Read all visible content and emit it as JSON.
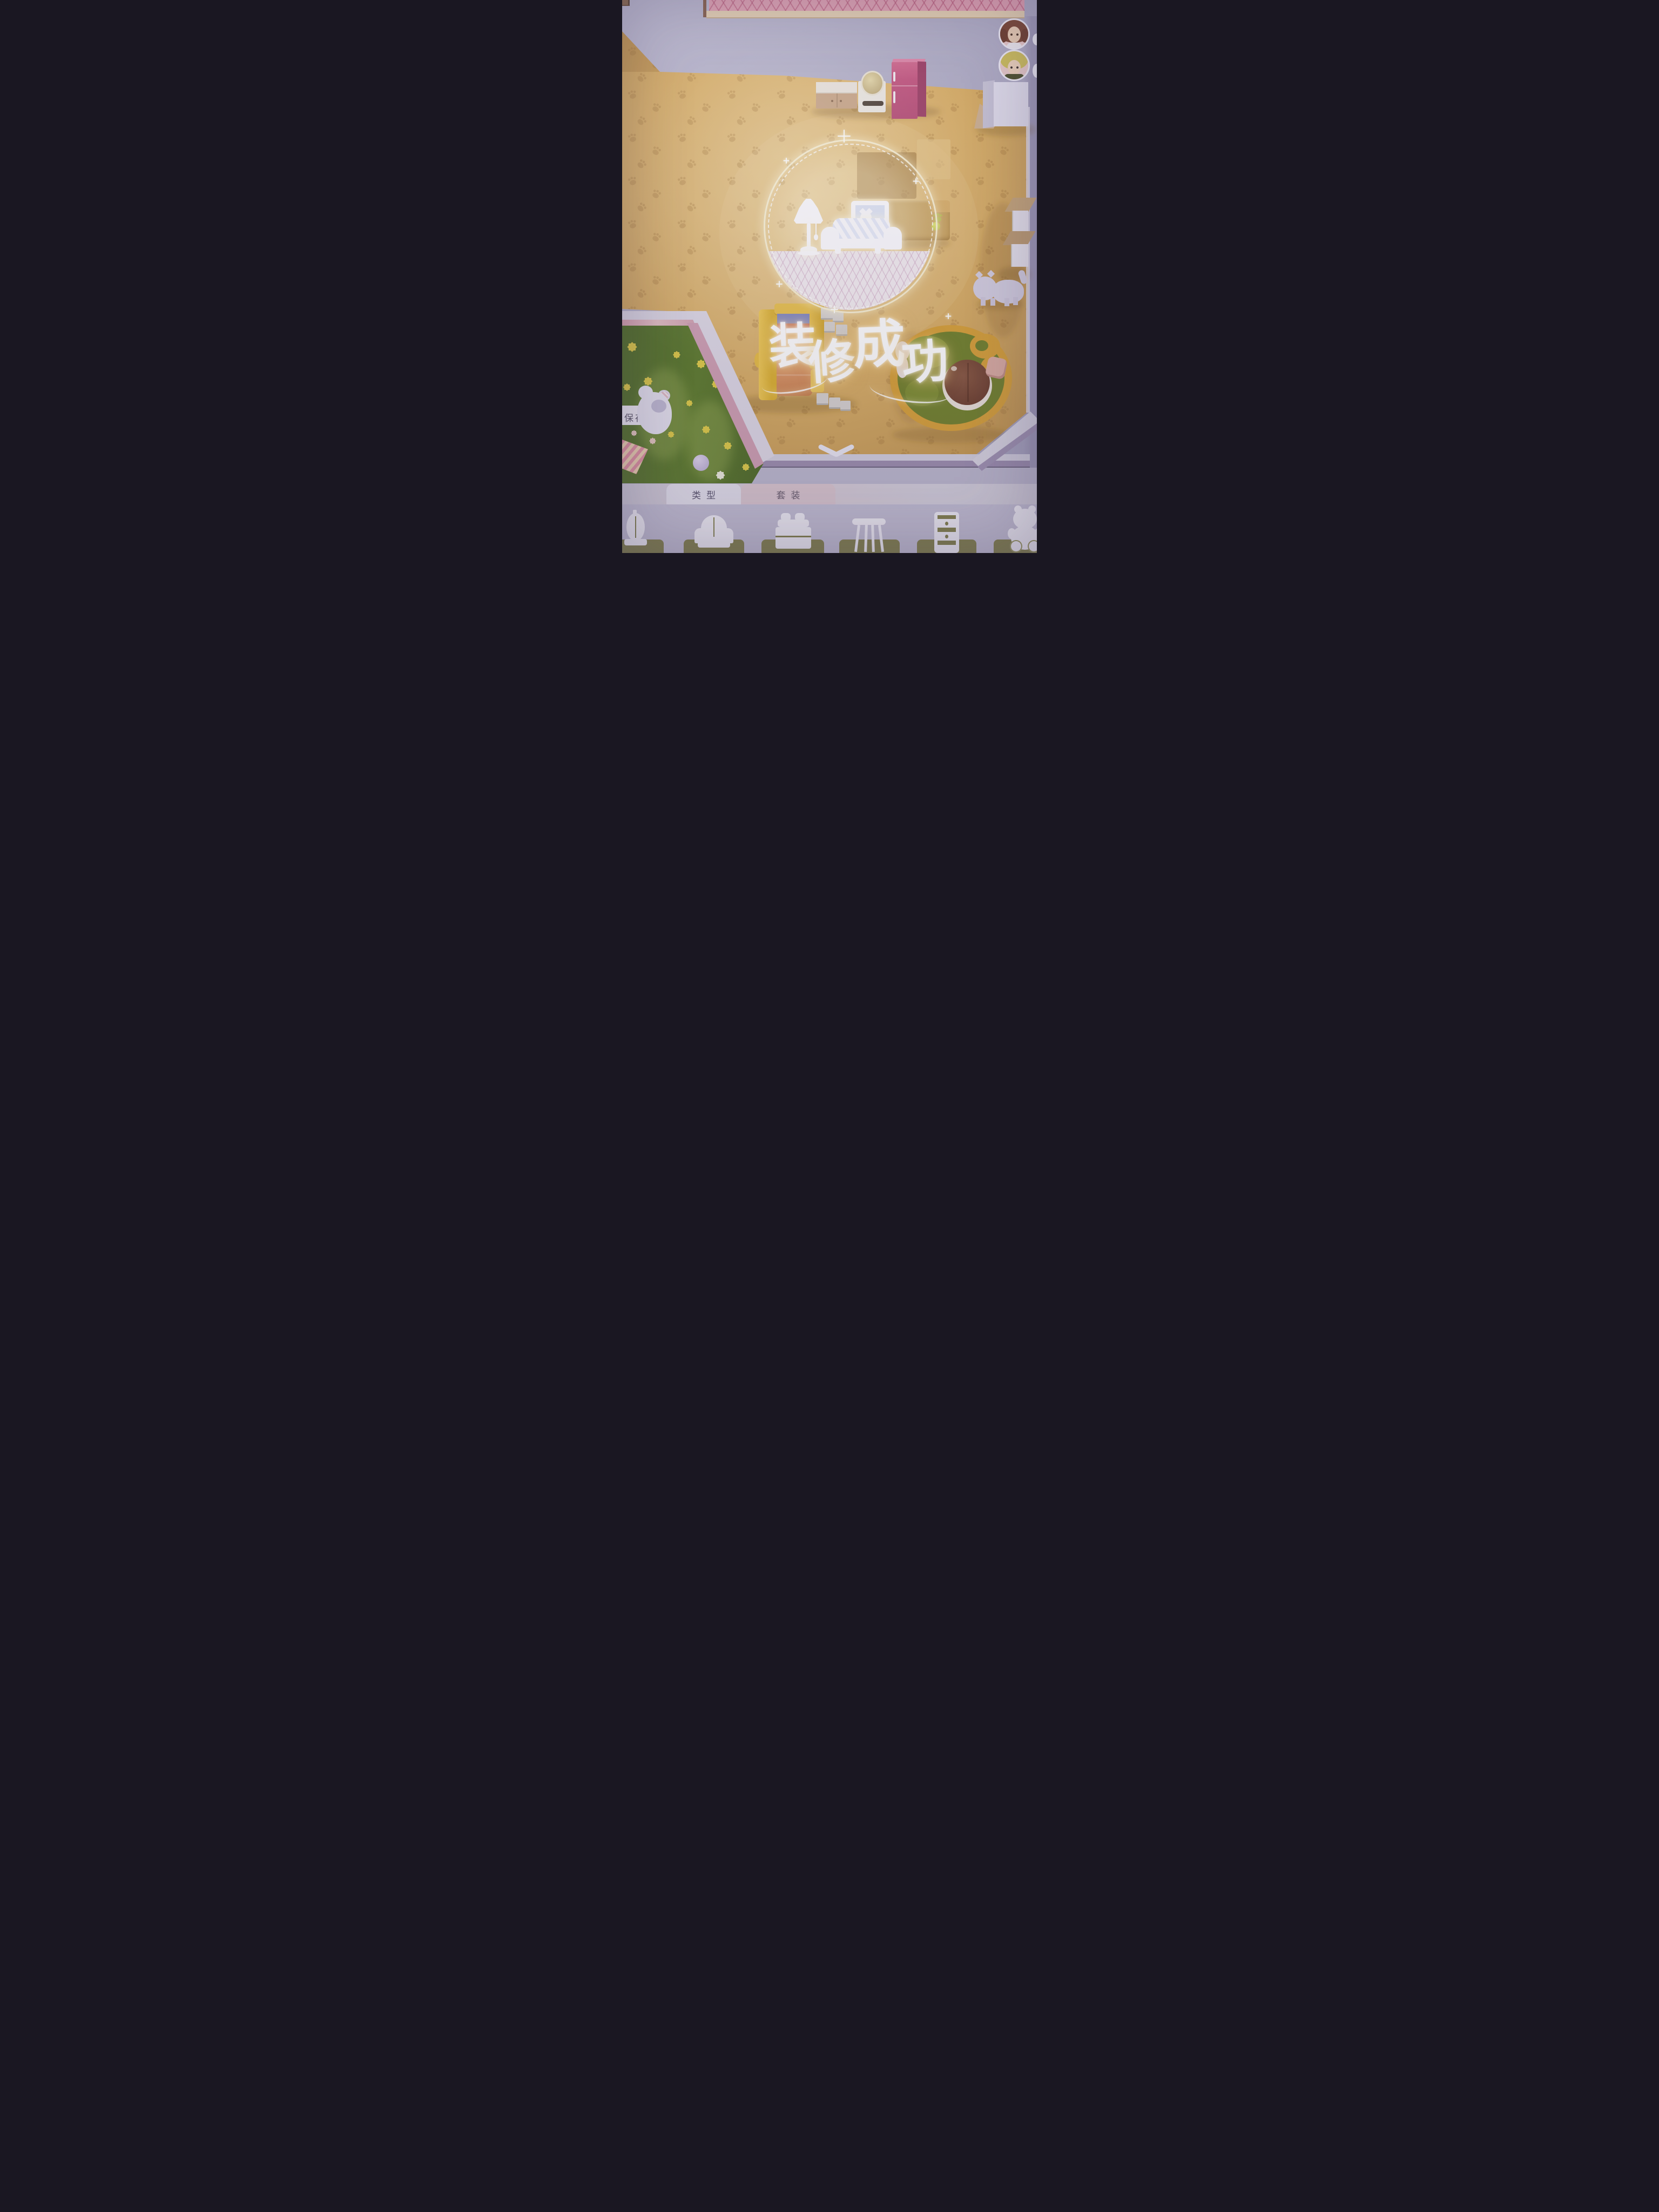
{
  "hud": {
    "save_button": {
      "label": "保存"
    },
    "avatars": [
      {
        "name": "girl-avatar"
      },
      {
        "name": "boy-avatar"
      }
    ]
  },
  "overlay": {
    "success_title": "装修成功",
    "success_chars": [
      "装",
      "修",
      "成",
      "功"
    ],
    "emblem_items": [
      "floor-lamp",
      "cat-picture",
      "sofa"
    ]
  },
  "bottom_panel": {
    "tabs": [
      {
        "label": "类型",
        "active": true
      },
      {
        "label": "套装",
        "active": false
      }
    ],
    "category_icons": [
      "cage-lamp",
      "armchair",
      "bed",
      "table",
      "dresser",
      "teddy-bear"
    ]
  },
  "colors": {
    "wall": "#b2afc7",
    "floor": "#d9af67",
    "roof_pink": "#e0a1b2",
    "fridge_pink": "#c2557f",
    "bed_yellow": "#e6bc45",
    "rug_border_orange": "#d8a23a",
    "rug_green": "#73832e",
    "garden_green": "#5a772c",
    "catalog_tile_olive": "#85834f"
  }
}
